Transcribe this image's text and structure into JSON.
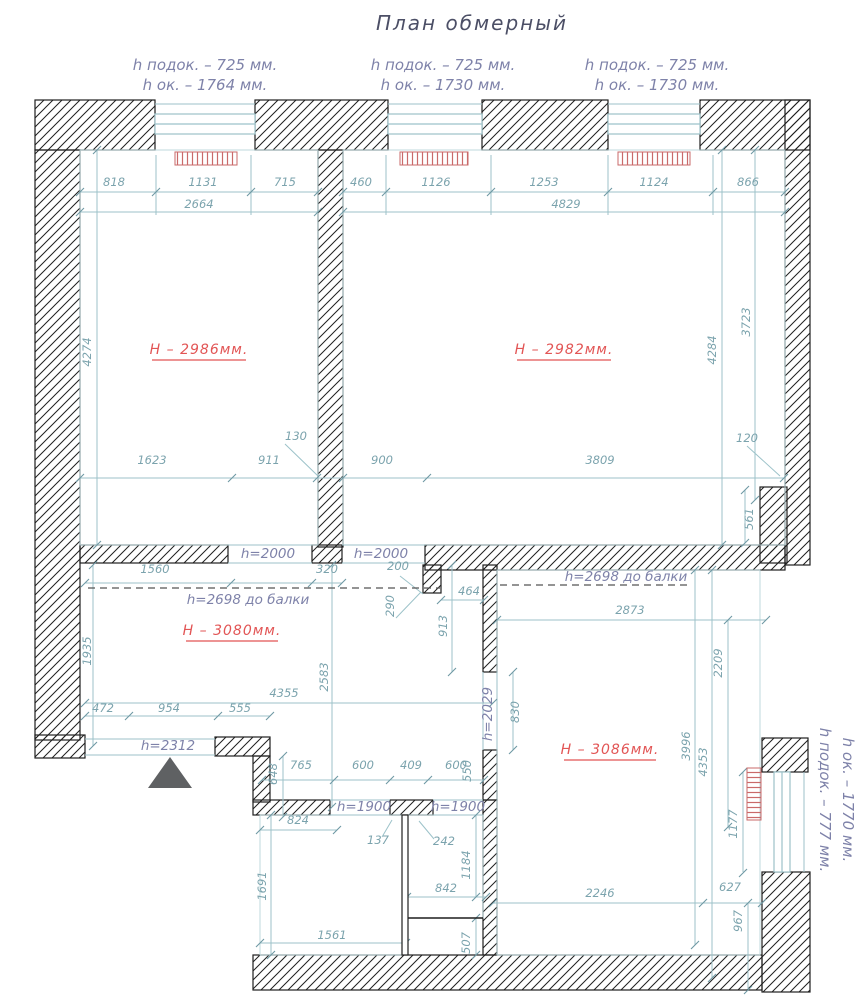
{
  "title": "План обмерный",
  "top_window_notes": [
    {
      "sill": "h подок. – 725 мм.",
      "window": "h ок. – 1764 мм."
    },
    {
      "sill": "h подок. – 725 мм.",
      "window": "h ок. – 1730 мм."
    },
    {
      "sill": "h подок. – 725 мм.",
      "window": "h ок. – 1730 мм."
    }
  ],
  "right_window_note": {
    "sill": "h подок. – 777 мм.",
    "window": "h ок. – 1770 мм."
  },
  "room_heights": {
    "top_left": "Н – 2986мм.",
    "top_right": "Н – 2982мм.",
    "hall": "Н – 3080мм.",
    "bottom_right": "Н – 3086мм."
  },
  "beam_notes": {
    "hall": "h=2698 до балки",
    "bottom_right": "h=2698 до балки"
  },
  "opening_heights": {
    "left_door": "h=2000",
    "right_door": "h=2000",
    "entrance": "h=2312",
    "bath_door": "h=1900",
    "wc_door": "h=1900",
    "room_door": "h=2029"
  },
  "colors": {
    "dimension_text": "#7ba3ad",
    "dimension_line": "#9cc2c9",
    "opening_text": "#7e82a9",
    "room_height_text": "#e25555",
    "wall": "#1f1f1f",
    "radiator": "#c96a6a"
  },
  "dims": [
    {
      "t": "818",
      "x": 114,
      "y": 186
    },
    {
      "t": "1131",
      "x": 203,
      "y": 186
    },
    {
      "t": "715",
      "x": 285,
      "y": 186
    },
    {
      "t": "2664",
      "x": 199,
      "y": 208
    },
    {
      "t": "460",
      "x": 361,
      "y": 186
    },
    {
      "t": "1126",
      "x": 436,
      "y": 186
    },
    {
      "t": "1253",
      "x": 544,
      "y": 186
    },
    {
      "t": "1124",
      "x": 654,
      "y": 186
    },
    {
      "t": "866",
      "x": 748,
      "y": 186
    },
    {
      "t": "4829",
      "x": 566,
      "y": 208
    },
    {
      "t": "4274",
      "x": 91,
      "y": 352,
      "r": -90
    },
    {
      "t": "4284",
      "x": 716,
      "y": 350,
      "r": -90
    },
    {
      "t": "3723",
      "x": 750,
      "y": 322,
      "r": -90
    },
    {
      "t": "1623",
      "x": 152,
      "y": 464
    },
    {
      "t": "911",
      "x": 269,
      "y": 464
    },
    {
      "t": "130",
      "x": 296,
      "y": 440
    },
    {
      "t": "900",
      "x": 382,
      "y": 464
    },
    {
      "t": "3809",
      "x": 600,
      "y": 464
    },
    {
      "t": "120",
      "x": 747,
      "y": 442
    },
    {
      "t": "561",
      "x": 753,
      "y": 519,
      "r": -90
    },
    {
      "t": "1560",
      "x": 155,
      "y": 573
    },
    {
      "t": "320",
      "x": 327,
      "y": 573
    },
    {
      "t": "200",
      "x": 398,
      "y": 570
    },
    {
      "t": "290",
      "x": 394,
      "y": 606,
      "r": -90
    },
    {
      "t": "464",
      "x": 469,
      "y": 595
    },
    {
      "t": "913",
      "x": 447,
      "y": 626,
      "r": -90
    },
    {
      "t": "2873",
      "x": 630,
      "y": 614
    },
    {
      "t": "2209",
      "x": 722,
      "y": 663,
      "r": -90
    },
    {
      "t": "1935",
      "x": 91,
      "y": 651,
      "r": -90
    },
    {
      "t": "4355",
      "x": 284,
      "y": 697
    },
    {
      "t": "2583",
      "x": 328,
      "y": 677,
      "r": -90
    },
    {
      "t": "472",
      "x": 103,
      "y": 712
    },
    {
      "t": "954",
      "x": 169,
      "y": 712
    },
    {
      "t": "555",
      "x": 240,
      "y": 712
    },
    {
      "t": "648",
      "x": 277,
      "y": 774,
      "r": -90
    },
    {
      "t": "765",
      "x": 301,
      "y": 769
    },
    {
      "t": "600",
      "x": 363,
      "y": 769
    },
    {
      "t": "409",
      "x": 411,
      "y": 769
    },
    {
      "t": "600",
      "x": 456,
      "y": 769
    },
    {
      "t": "550",
      "x": 471,
      "y": 771,
      "r": -90
    },
    {
      "t": "830",
      "x": 519,
      "y": 712,
      "r": -90
    },
    {
      "t": "3996",
      "x": 690,
      "y": 746,
      "r": -90
    },
    {
      "t": "4353",
      "x": 707,
      "y": 762,
      "r": -90
    },
    {
      "t": "824",
      "x": 298,
      "y": 824
    },
    {
      "t": "137",
      "x": 378,
      "y": 844
    },
    {
      "t": "242",
      "x": 444,
      "y": 845
    },
    {
      "t": "1184",
      "x": 470,
      "y": 865,
      "r": -90
    },
    {
      "t": "1691",
      "x": 266,
      "y": 886,
      "r": -90
    },
    {
      "t": "842",
      "x": 446,
      "y": 892
    },
    {
      "t": "507",
      "x": 470,
      "y": 943,
      "r": -90
    },
    {
      "t": "1561",
      "x": 332,
      "y": 939
    },
    {
      "t": "2246",
      "x": 600,
      "y": 897
    },
    {
      "t": "627",
      "x": 730,
      "y": 891
    },
    {
      "t": "967",
      "x": 742,
      "y": 921,
      "r": -90
    },
    {
      "t": "1177",
      "x": 737,
      "y": 824,
      "r": -90
    }
  ]
}
